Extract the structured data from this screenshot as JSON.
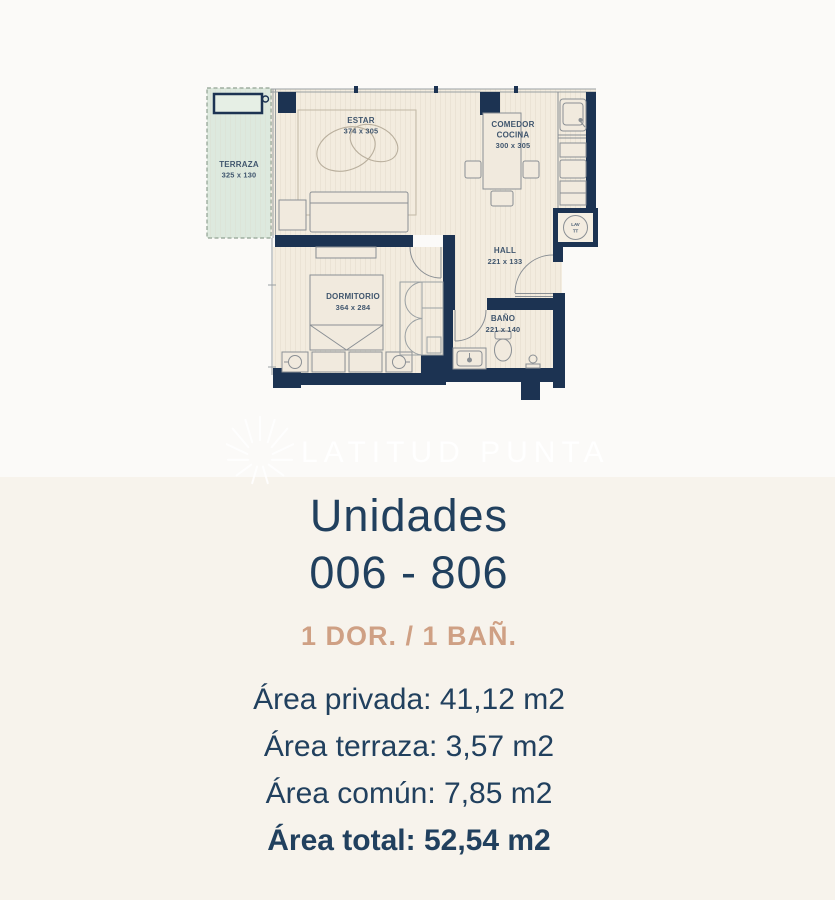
{
  "watermark": {
    "brand": "LATITUD PUNTA"
  },
  "plan": {
    "terraza": {
      "name": "TERRAZA",
      "dims": "325 x 130"
    },
    "estar": {
      "name": "ESTAR",
      "dims": "374 x 305"
    },
    "comedor": {
      "line1": "COMEDOR",
      "line2": "COCINA",
      "dims": "300 x 305"
    },
    "hall": {
      "name": "HALL",
      "dims": "221 x 133"
    },
    "dormitorio": {
      "name": "DORMITORIO",
      "dims": "364 x 284"
    },
    "bano": {
      "name": "BAÑO",
      "dims": "221 x 140"
    },
    "lav": {
      "line1": "LAV",
      "line2": "TT"
    }
  },
  "unit": {
    "title": "Unidades",
    "range": "006 - 806",
    "config": "1 DOR. / 1 BAÑ.",
    "areas": [
      {
        "label": "Área privada:",
        "value": "41,12 m2"
      },
      {
        "label": "Área terraza:",
        "value": "3,57 m2"
      },
      {
        "label": "Área común:",
        "value": "7,85 m2"
      },
      {
        "label": "Área total:",
        "value": "52,54 m2"
      }
    ]
  },
  "colors": {
    "wall_navy": "#1c3352",
    "floor_beige": "#f3ecdf",
    "terrace_green": "#dde9de",
    "text_navy": "#21405e",
    "accent_tan": "#cfa084",
    "bg_top": "#fbfaf8",
    "bg_bottom": "#f7f3ec"
  }
}
